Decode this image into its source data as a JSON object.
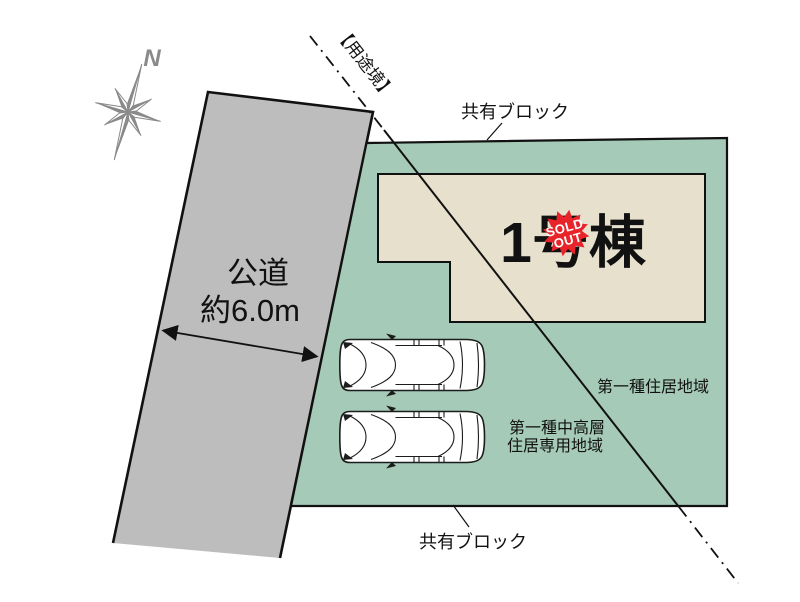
{
  "compass": {
    "north_label": "N"
  },
  "road": {
    "label_line1": "公道",
    "label_line2": "約6.0m"
  },
  "boundary": {
    "label": "【用途境】"
  },
  "site": {
    "shared_block_top": "共有ブロック",
    "shared_block_bottom": "共有ブロック",
    "zone_right": "第一種住居地域",
    "zone_left_line1": "第一種中高層",
    "zone_left_line2": "住居専用地域"
  },
  "building": {
    "label": "1号棟",
    "sold_out_line1": "SOLD",
    "sold_out_line2": "OUT"
  },
  "colors": {
    "plot_green": "#a5cab7",
    "building_beige": "#e6e0cd",
    "road_gray": "#bdbdbd",
    "line_black": "#111111",
    "badge_red": "#e82329",
    "compass_gray": "#8a8a8a"
  }
}
